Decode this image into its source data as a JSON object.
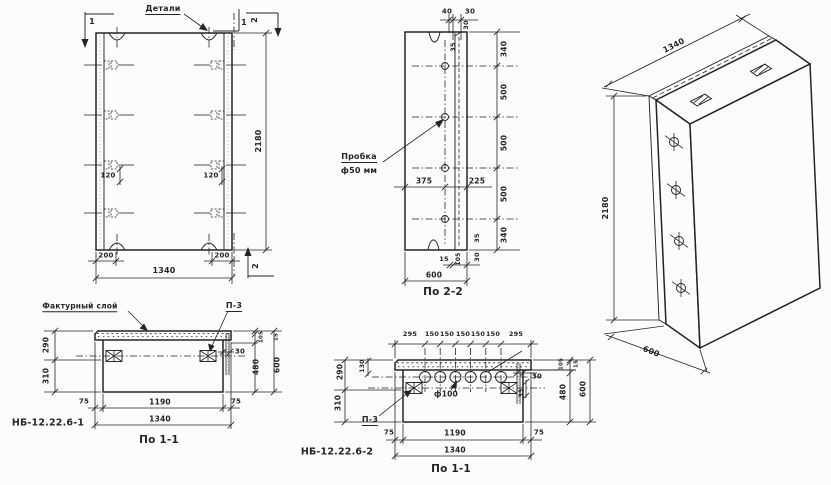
{
  "meta": {
    "paper_color": "#fcfcfa",
    "ink_color": "#242424",
    "drawing_type": "precast concrete panel working drawing"
  },
  "views": {
    "front_view": {
      "labels": [
        {
          "n": "label-details",
          "t": "Детали",
          "x": 163,
          "y": 10,
          "fs": 8,
          "u": true
        },
        {
          "n": "marker-1-top-left",
          "t": "1",
          "x": 92,
          "y": 22,
          "fs": 8
        },
        {
          "n": "marker-1-top-right",
          "t": "1",
          "x": 244,
          "y": 23,
          "fs": 8
        },
        {
          "n": "marker-2-top-right",
          "t": "2",
          "x": 255,
          "y": 20,
          "fs": 8,
          "r": -90
        },
        {
          "n": "marker-2-bottom-right",
          "t": "2",
          "x": 256,
          "y": 266,
          "fs": 8,
          "r": -90
        },
        {
          "n": "dim-height",
          "t": "2180",
          "x": 259,
          "y": 141,
          "fs": 8,
          "r": -90
        },
        {
          "n": "dim-anchor-left",
          "t": "120",
          "x": 108,
          "y": 176,
          "fs": 7
        },
        {
          "n": "dim-anchor-right",
          "t": "120",
          "x": 211,
          "y": 176,
          "fs": 7
        },
        {
          "n": "dim-edge-left",
          "t": "200",
          "x": 106,
          "y": 256,
          "fs": 7
        },
        {
          "n": "dim-edge-right",
          "t": "200",
          "x": 222,
          "y": 256,
          "fs": 7
        },
        {
          "n": "dim-width",
          "t": "1340",
          "x": 164,
          "y": 271,
          "fs": 8
        }
      ]
    },
    "section_2_2": {
      "labels": [
        {
          "n": "dim-top-40",
          "t": "40",
          "x": 447,
          "y": 12,
          "fs": 7
        },
        {
          "n": "dim-top-30",
          "t": "30",
          "x": 470,
          "y": 12,
          "fs": 7
        },
        {
          "n": "dim-30-upper",
          "t": "30",
          "x": 466,
          "y": 25,
          "fs": 6.5,
          "r": -90
        },
        {
          "n": "dim-35-upper",
          "t": "35",
          "x": 453,
          "y": 47,
          "fs": 6.5,
          "r": -90
        },
        {
          "n": "dim-340-top",
          "t": "340",
          "x": 504,
          "y": 49,
          "fs": 7.5,
          "r": -90
        },
        {
          "n": "dim-500-a",
          "t": "500",
          "x": 504,
          "y": 92,
          "fs": 7.5,
          "r": -90
        },
        {
          "n": "dim-500-b",
          "t": "500",
          "x": 504,
          "y": 143,
          "fs": 7.5,
          "r": -90
        },
        {
          "n": "dim-500-c",
          "t": "500",
          "x": 504,
          "y": 194,
          "fs": 7.5,
          "r": -90
        },
        {
          "n": "dim-340-bottom",
          "t": "340",
          "x": 504,
          "y": 235,
          "fs": 7.5,
          "r": -90
        },
        {
          "n": "dim-35-lower",
          "t": "35",
          "x": 477,
          "y": 238,
          "fs": 6.5,
          "r": -90
        },
        {
          "n": "dim-30-lower",
          "t": "30",
          "x": 477,
          "y": 257,
          "fs": 6.5,
          "r": -90
        },
        {
          "n": "label-plug-line1",
          "t": "Пробка",
          "x": 359,
          "y": 158,
          "fs": 8,
          "u": true
        },
        {
          "n": "label-plug-line2",
          "t": "ф50 мм",
          "x": 359,
          "y": 171,
          "fs": 8
        },
        {
          "n": "dim-375",
          "t": "375",
          "x": 424,
          "y": 181,
          "fs": 7.5
        },
        {
          "n": "dim-225",
          "t": "225",
          "x": 477,
          "y": 181,
          "fs": 7.5
        },
        {
          "n": "dim-15",
          "t": "15",
          "x": 444,
          "y": 259,
          "fs": 6.5
        },
        {
          "n": "dim-105",
          "t": "105",
          "x": 459,
          "y": 259,
          "fs": 6,
          "r": -90
        },
        {
          "n": "dim-600",
          "t": "600",
          "x": 434,
          "y": 275,
          "fs": 7.5
        },
        {
          "n": "view-title",
          "t": "По 2-2",
          "x": 443,
          "y": 292,
          "fs": 10.5
        }
      ]
    },
    "axonometric": {
      "labels": [
        {
          "n": "dim-width",
          "t": "1340",
          "x": 674,
          "y": 46,
          "fs": 8,
          "r": -27
        },
        {
          "n": "dim-height",
          "t": "2180",
          "x": 606,
          "y": 208,
          "fs": 8,
          "r": -90
        },
        {
          "n": "dim-depth",
          "t": "600",
          "x": 651,
          "y": 352,
          "fs": 8,
          "r": 22
        }
      ]
    },
    "section_1_1_type1": {
      "labels": [
        {
          "n": "label-facing-layer",
          "t": "Фактурный слой",
          "x": 80,
          "y": 307,
          "fs": 7.5,
          "u": true
        },
        {
          "n": "label-p3",
          "t": "П-3",
          "x": 234,
          "y": 307,
          "fs": 8,
          "u": true
        },
        {
          "n": "dim-290",
          "t": "290",
          "x": 46,
          "y": 345,
          "fs": 7.5,
          "r": -90
        },
        {
          "n": "dim-310",
          "t": "310",
          "x": 46,
          "y": 376,
          "fs": 7.5,
          "r": -90
        },
        {
          "n": "dim-30",
          "t": "30",
          "x": 240,
          "y": 352,
          "fs": 7
        },
        {
          "n": "dim-105",
          "t": "105",
          "x": 262,
          "y": 337,
          "fs": 5.5,
          "r": -90
        },
        {
          "n": "dim-15",
          "t": "15",
          "x": 277,
          "y": 337,
          "fs": 5.5,
          "r": -90
        },
        {
          "n": "dim-480",
          "t": "480",
          "x": 256,
          "y": 367,
          "fs": 7.5,
          "r": -90
        },
        {
          "n": "dim-600",
          "t": "600",
          "x": 277,
          "y": 365,
          "fs": 7.5,
          "r": -90
        },
        {
          "n": "dim-75-left",
          "t": "75",
          "x": 84,
          "y": 402,
          "fs": 7
        },
        {
          "n": "dim-1190",
          "t": "1190",
          "x": 160,
          "y": 402,
          "fs": 7.5
        },
        {
          "n": "dim-75-right",
          "t": "75",
          "x": 236,
          "y": 402,
          "fs": 7
        },
        {
          "n": "dim-1340",
          "t": "1340",
          "x": 160,
          "y": 419,
          "fs": 7.5
        },
        {
          "n": "product-mark",
          "t": "НБ-12.22.6-1",
          "x": 48,
          "y": 423,
          "fs": 9.5
        },
        {
          "n": "view-title",
          "t": "По 1-1",
          "x": 159,
          "y": 440,
          "fs": 10.5
        }
      ]
    },
    "section_1_1_type2": {
      "labels": [
        {
          "n": "dim-295-left",
          "t": "295",
          "x": 410,
          "y": 334,
          "fs": 6.5
        },
        {
          "n": "dim-150-a",
          "t": "150",
          "x": 432,
          "y": 334,
          "fs": 6.5
        },
        {
          "n": "dim-150-b",
          "t": "150",
          "x": 447,
          "y": 334,
          "fs": 6.5
        },
        {
          "n": "dim-150-c",
          "t": "150",
          "x": 463,
          "y": 334,
          "fs": 6.5
        },
        {
          "n": "dim-150-d",
          "t": "150",
          "x": 478,
          "y": 334,
          "fs": 6.5
        },
        {
          "n": "dim-150-e",
          "t": "150",
          "x": 493,
          "y": 334,
          "fs": 6.5
        },
        {
          "n": "dim-295-right",
          "t": "295",
          "x": 516,
          "y": 334,
          "fs": 6.5
        },
        {
          "n": "dim-130",
          "t": "130",
          "x": 363,
          "y": 366,
          "fs": 6,
          "r": -90
        },
        {
          "n": "dim-290",
          "t": "290",
          "x": 340,
          "y": 372,
          "fs": 7.5,
          "r": -90
        },
        {
          "n": "dim-310",
          "t": "310",
          "x": 338,
          "y": 403,
          "fs": 7.5,
          "r": -90
        },
        {
          "n": "dim-30",
          "t": "30",
          "x": 537,
          "y": 377,
          "fs": 7
        },
        {
          "n": "dim-35",
          "t": "35",
          "x": 522,
          "y": 393,
          "fs": 6,
          "r": -90
        },
        {
          "n": "dim-105",
          "t": "105",
          "x": 562,
          "y": 364,
          "fs": 5.5,
          "r": -90
        },
        {
          "n": "dim-15",
          "t": "15",
          "x": 577,
          "y": 364,
          "fs": 5.5,
          "r": -90
        },
        {
          "n": "dim-480",
          "t": "480",
          "x": 563,
          "y": 392,
          "fs": 7.5,
          "r": -90
        },
        {
          "n": "dim-600",
          "t": "600",
          "x": 583,
          "y": 389,
          "fs": 7.5,
          "r": -90
        },
        {
          "n": "label-hole-dia",
          "t": "ф100",
          "x": 446,
          "y": 394,
          "fs": 7.5
        },
        {
          "n": "label-p3",
          "t": "П-3",
          "x": 370,
          "y": 421,
          "fs": 8,
          "u": true
        },
        {
          "n": "dim-75-left",
          "t": "75",
          "x": 389,
          "y": 433,
          "fs": 7
        },
        {
          "n": "dim-1190",
          "t": "1190",
          "x": 455,
          "y": 433,
          "fs": 7.5
        },
        {
          "n": "dim-75-right",
          "t": "75",
          "x": 539,
          "y": 433,
          "fs": 7
        },
        {
          "n": "dim-1340",
          "t": "1340",
          "x": 455,
          "y": 450,
          "fs": 7.5
        },
        {
          "n": "product-mark",
          "t": "НБ-12.22.6-2",
          "x": 337,
          "y": 452,
          "fs": 9.5
        },
        {
          "n": "view-title",
          "t": "По 1-1",
          "x": 451,
          "y": 469,
          "fs": 10.5
        }
      ]
    }
  }
}
